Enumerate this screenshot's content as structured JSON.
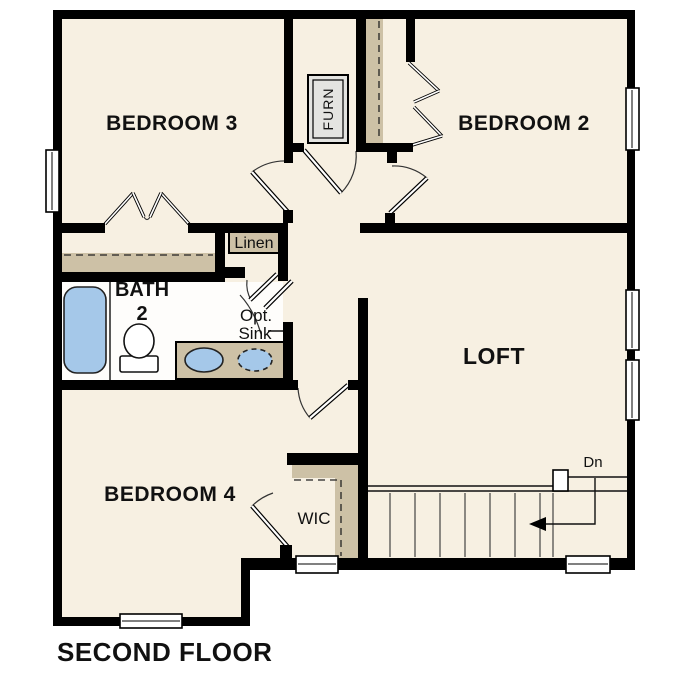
{
  "title": "SECOND FLOOR",
  "floor_plan": {
    "rooms": {
      "bedroom3": "BEDROOM 3",
      "bedroom2": "BEDROOM 2",
      "bedroom4": "BEDROOM 4",
      "loft": "LOFT",
      "bath_line1": "BATH",
      "bath_line2": "2",
      "linen": "Linen",
      "furnace": "FURN",
      "opt_sink_line1": "Opt.",
      "opt_sink_line2": "Sink",
      "wic": "WIC",
      "stairs_direction": "Dn"
    },
    "colors": {
      "wall": "#000000",
      "floor": "#F7F0E2",
      "bath_floor": "#FEFDFB",
      "shelf": "#CDC1A6",
      "fixture_blue": "#A5C8E9",
      "furnace_fill": "#E4E4E1"
    }
  }
}
